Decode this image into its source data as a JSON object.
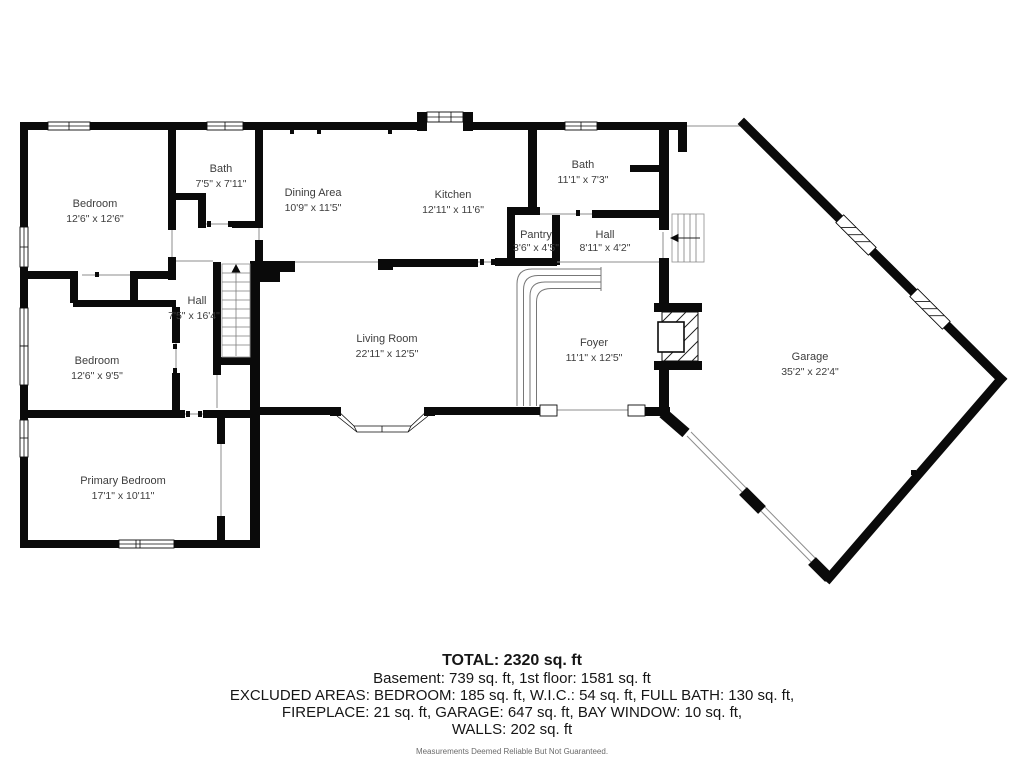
{
  "plan": {
    "rooms": [
      {
        "id": "bedroom-1",
        "name": "Bedroom",
        "dims": "12'6\" x 12'6\""
      },
      {
        "id": "bath-1",
        "name": "Bath",
        "dims": "7'5\" x 7'11\""
      },
      {
        "id": "dining-area",
        "name": "Dining Area",
        "dims": "10'9\" x 11'5\""
      },
      {
        "id": "kitchen",
        "name": "Kitchen",
        "dims": "12'11\" x 11'6\""
      },
      {
        "id": "bath-2",
        "name": "Bath",
        "dims": "11'1\" x 7'3\""
      },
      {
        "id": "pantry",
        "name": "Pantry",
        "dims": "3'6\" x 4'5\""
      },
      {
        "id": "hall-upper",
        "name": "Hall",
        "dims": "8'11\" x 4'2\""
      },
      {
        "id": "hall-main",
        "name": "Hall",
        "dims": "7'5\" x 16'4\""
      },
      {
        "id": "bedroom-2",
        "name": "Bedroom",
        "dims": "12'6\" x 9'5\""
      },
      {
        "id": "living-room",
        "name": "Living Room",
        "dims": "22'11\" x 12'5\""
      },
      {
        "id": "foyer",
        "name": "Foyer",
        "dims": "11'1\" x 12'5\""
      },
      {
        "id": "garage",
        "name": "Garage",
        "dims": "35'2\" x 22'4\""
      },
      {
        "id": "primary-bedroom",
        "name": "Primary Bedroom",
        "dims": "17'1\" x 10'11\""
      }
    ],
    "summary": {
      "total": "TOTAL: 2320 sq. ft",
      "floors": "Basement: 739 sq. ft, 1st floor: 1581 sq. ft",
      "excluded_1": "EXCLUDED AREAS: BEDROOM: 185 sq. ft, W.I.C.: 54 sq. ft, FULL BATH: 130 sq. ft,",
      "excluded_2": "FIREPLACE: 21 sq. ft, GARAGE: 647 sq. ft, BAY WINDOW: 10 sq. ft,",
      "excluded_3": "WALLS: 202 sq. ft",
      "disclaimer": "Measurements Deemed Reliable But Not Guaranteed."
    },
    "colors": {
      "wall": "#0a0a0a",
      "label_text": "#3d3d3d",
      "thin_line": "#8c8c8c"
    }
  }
}
